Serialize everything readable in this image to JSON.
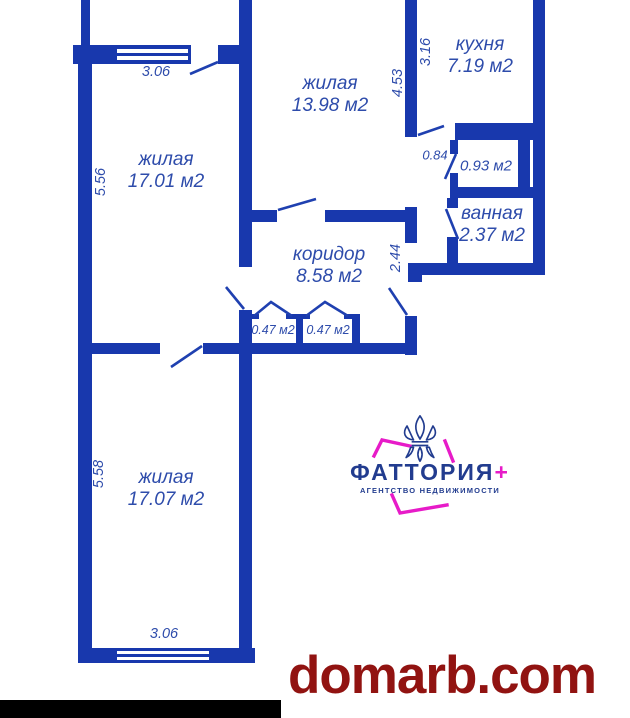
{
  "floorplan": {
    "rooms": [
      {
        "name": "жилая",
        "area": "17.01 м2"
      },
      {
        "name": "жилая",
        "area": "13.98 м2"
      },
      {
        "name": "кухня",
        "area": "7.19 м2"
      },
      {
        "area": "0.93 м2"
      },
      {
        "name": "ванная",
        "area": "2.37 м2"
      },
      {
        "name": "коридор",
        "area": "8.58 м2"
      },
      {
        "area": "0.47 м2"
      },
      {
        "area": "0.47 м2"
      },
      {
        "name": "жилая",
        "area": "17.07 м2"
      }
    ],
    "dims": {
      "w_top": "3.06",
      "h_room1": "5.56",
      "h_room2": "4.53",
      "h_kitchen": "3.16",
      "w_kitchen_door": "0.84",
      "h_corridor": "2.44",
      "h_room3": "5.58",
      "w_bottom": "3.06"
    }
  },
  "logo": {
    "name": "ФАТТОРИЯ",
    "plus": "+",
    "subtitle": "АГЕНТСТВО НЕДВИЖИМОСТИ"
  },
  "watermark": {
    "text": "domarb.com"
  },
  "colors": {
    "wall": "#1838ad",
    "label": "#2e4cab",
    "brand_navy": "#223c8f",
    "brand_magenta": "#e71bc8",
    "watermark_red": "#911311",
    "bottom_bar": "#000000"
  }
}
